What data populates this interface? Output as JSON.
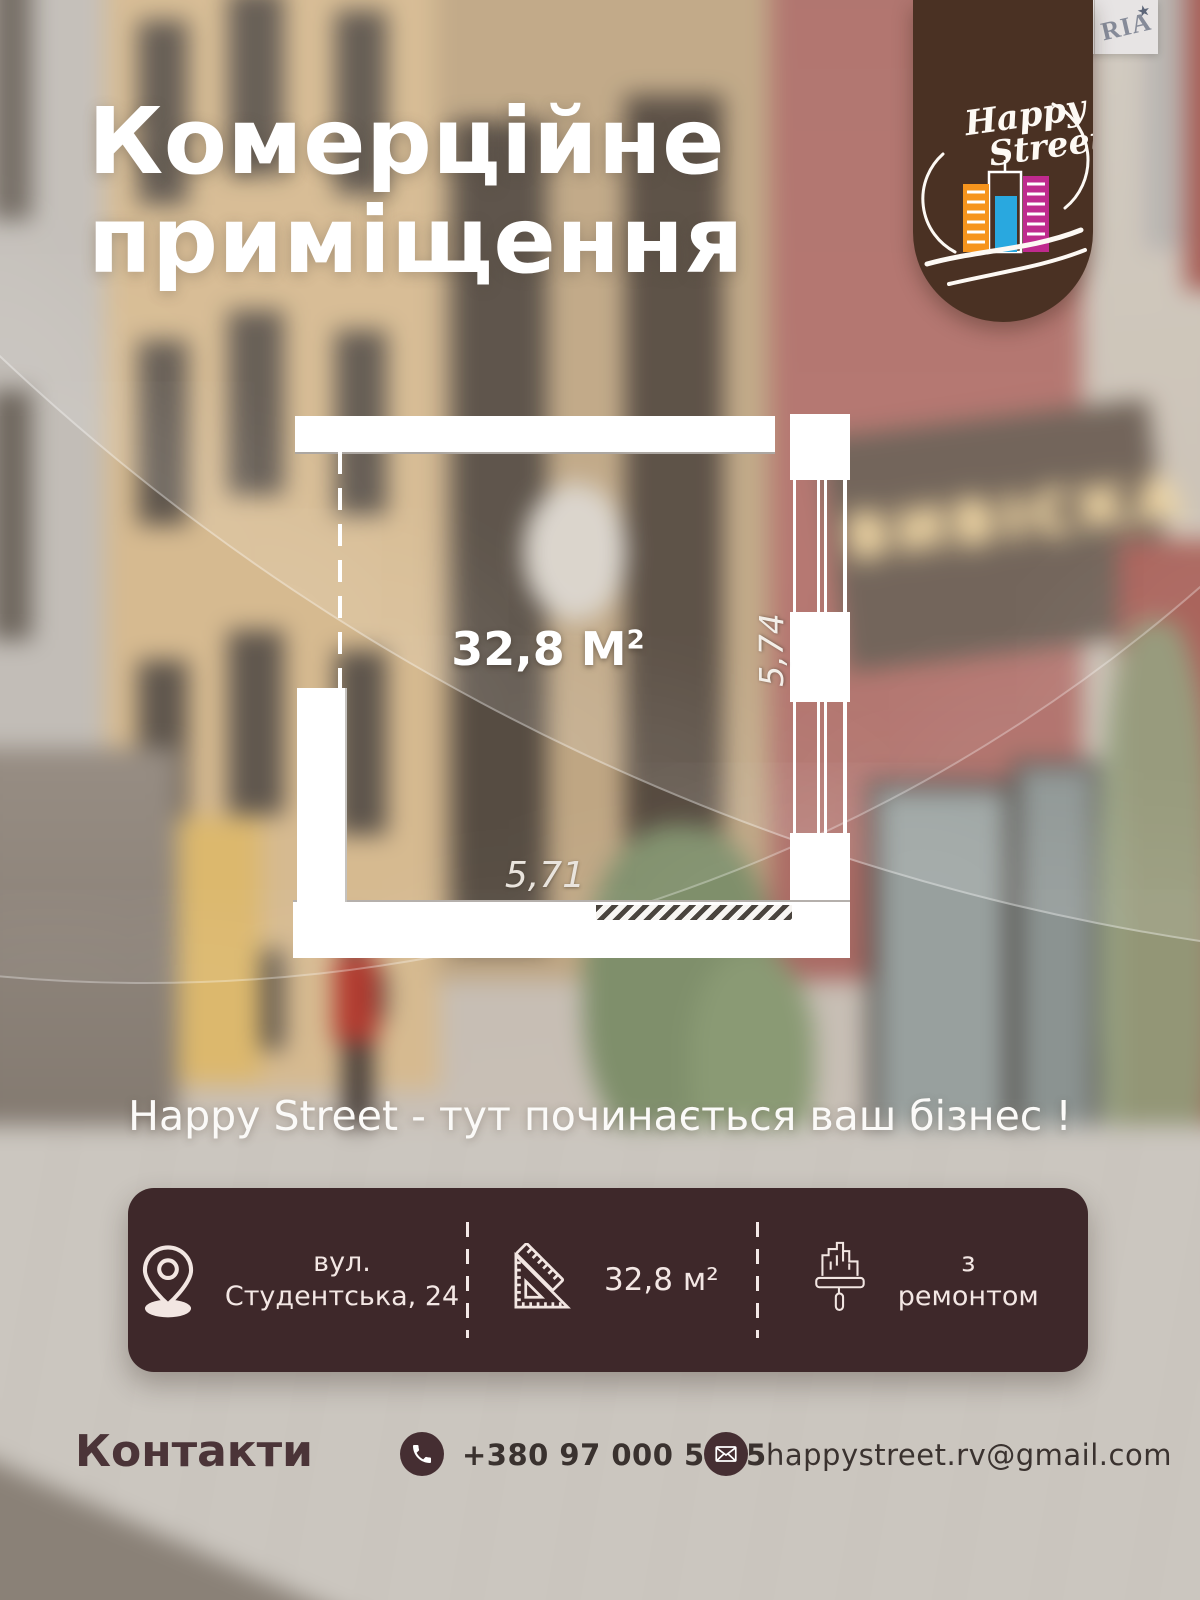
{
  "brand_badge": {
    "dim": "dim",
    "ria": "RIA",
    "star": "★"
  },
  "logo_badge": {
    "line1": "Happy",
    "line2": "Street"
  },
  "title": {
    "line1": "Комерційне",
    "line2": "приміщення"
  },
  "background": {
    "sign_text": "ВИВІСКА"
  },
  "floor_plan": {
    "area_value": "32,8 М",
    "area_sup": "2",
    "dim_right": "5,74",
    "dim_bottom": "5,71"
  },
  "tagline": {
    "text": "Happy Street - тут починається ваш бізнес !"
  },
  "info_bar": {
    "location": {
      "line1": "вул.",
      "line2": "Студентська, 24"
    },
    "area": {
      "value": "32,8 м²"
    },
    "condition": {
      "line1": "з",
      "line2": "ремонтом"
    }
  },
  "contacts": {
    "heading": "Контакти",
    "phone": "+380 97 000 5515",
    "email": "happystreet.rv@gmail.com"
  },
  "colors": {
    "badge_brown": "#4a3123",
    "info_bar": "#3e282a",
    "accent_text": "#4b3438",
    "sign_glow": "#f4d9a4",
    "plan_white": "#ffffff"
  }
}
